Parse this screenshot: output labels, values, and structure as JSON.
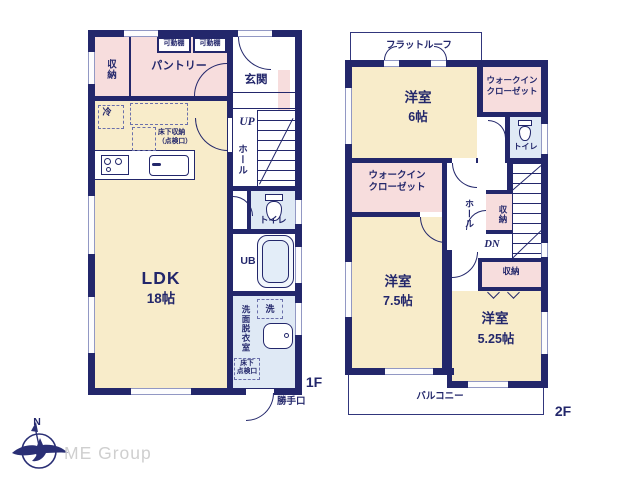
{
  "colors": {
    "wall": "#23276b",
    "room_cream": "#f8ecca",
    "room_pink": "#f7dddd",
    "room_blue": "#dfe9f5",
    "text": "#23276b",
    "brand_gray": "#cfcfcf"
  },
  "f1": {
    "floor_label": "1F",
    "closet": "収納",
    "shelf1": "可動棚",
    "shelf2": "可動棚",
    "pantry": "パントリー",
    "entrance": "玄関",
    "up": "UP",
    "hall": "ホール",
    "toilet": "トイレ",
    "ub": "UB",
    "fridge": "冷",
    "underfloor1": "床下収納",
    "underfloor2": "（点検口）",
    "ldk1": "LDK",
    "ldk2": "18帖",
    "laundry": "洗",
    "washroom": "洗面脱衣室",
    "hatch1": "床下",
    "hatch2": "点検口",
    "backdoor": "勝手口"
  },
  "f2": {
    "floor_label": "2F",
    "flat_roof": "フラットルーフ",
    "room6_1": "洋室",
    "room6_2": "6帖",
    "wic_a1": "ウォークイン",
    "wic_a2": "クローゼット",
    "toilet": "トイレ",
    "wic_b1": "ウォークイン",
    "wic_b2": "クローゼット",
    "hall": "ホール",
    "storage_a": "収納",
    "dn": "DN",
    "storage_b": "収納",
    "room75_1": "洋室",
    "room75_2": "7.5帖",
    "room525_1": "洋室",
    "room525_2": "5.25帖",
    "balcony": "バルコニー"
  },
  "footer": {
    "brand": "ME Group",
    "compass_n": "N"
  }
}
